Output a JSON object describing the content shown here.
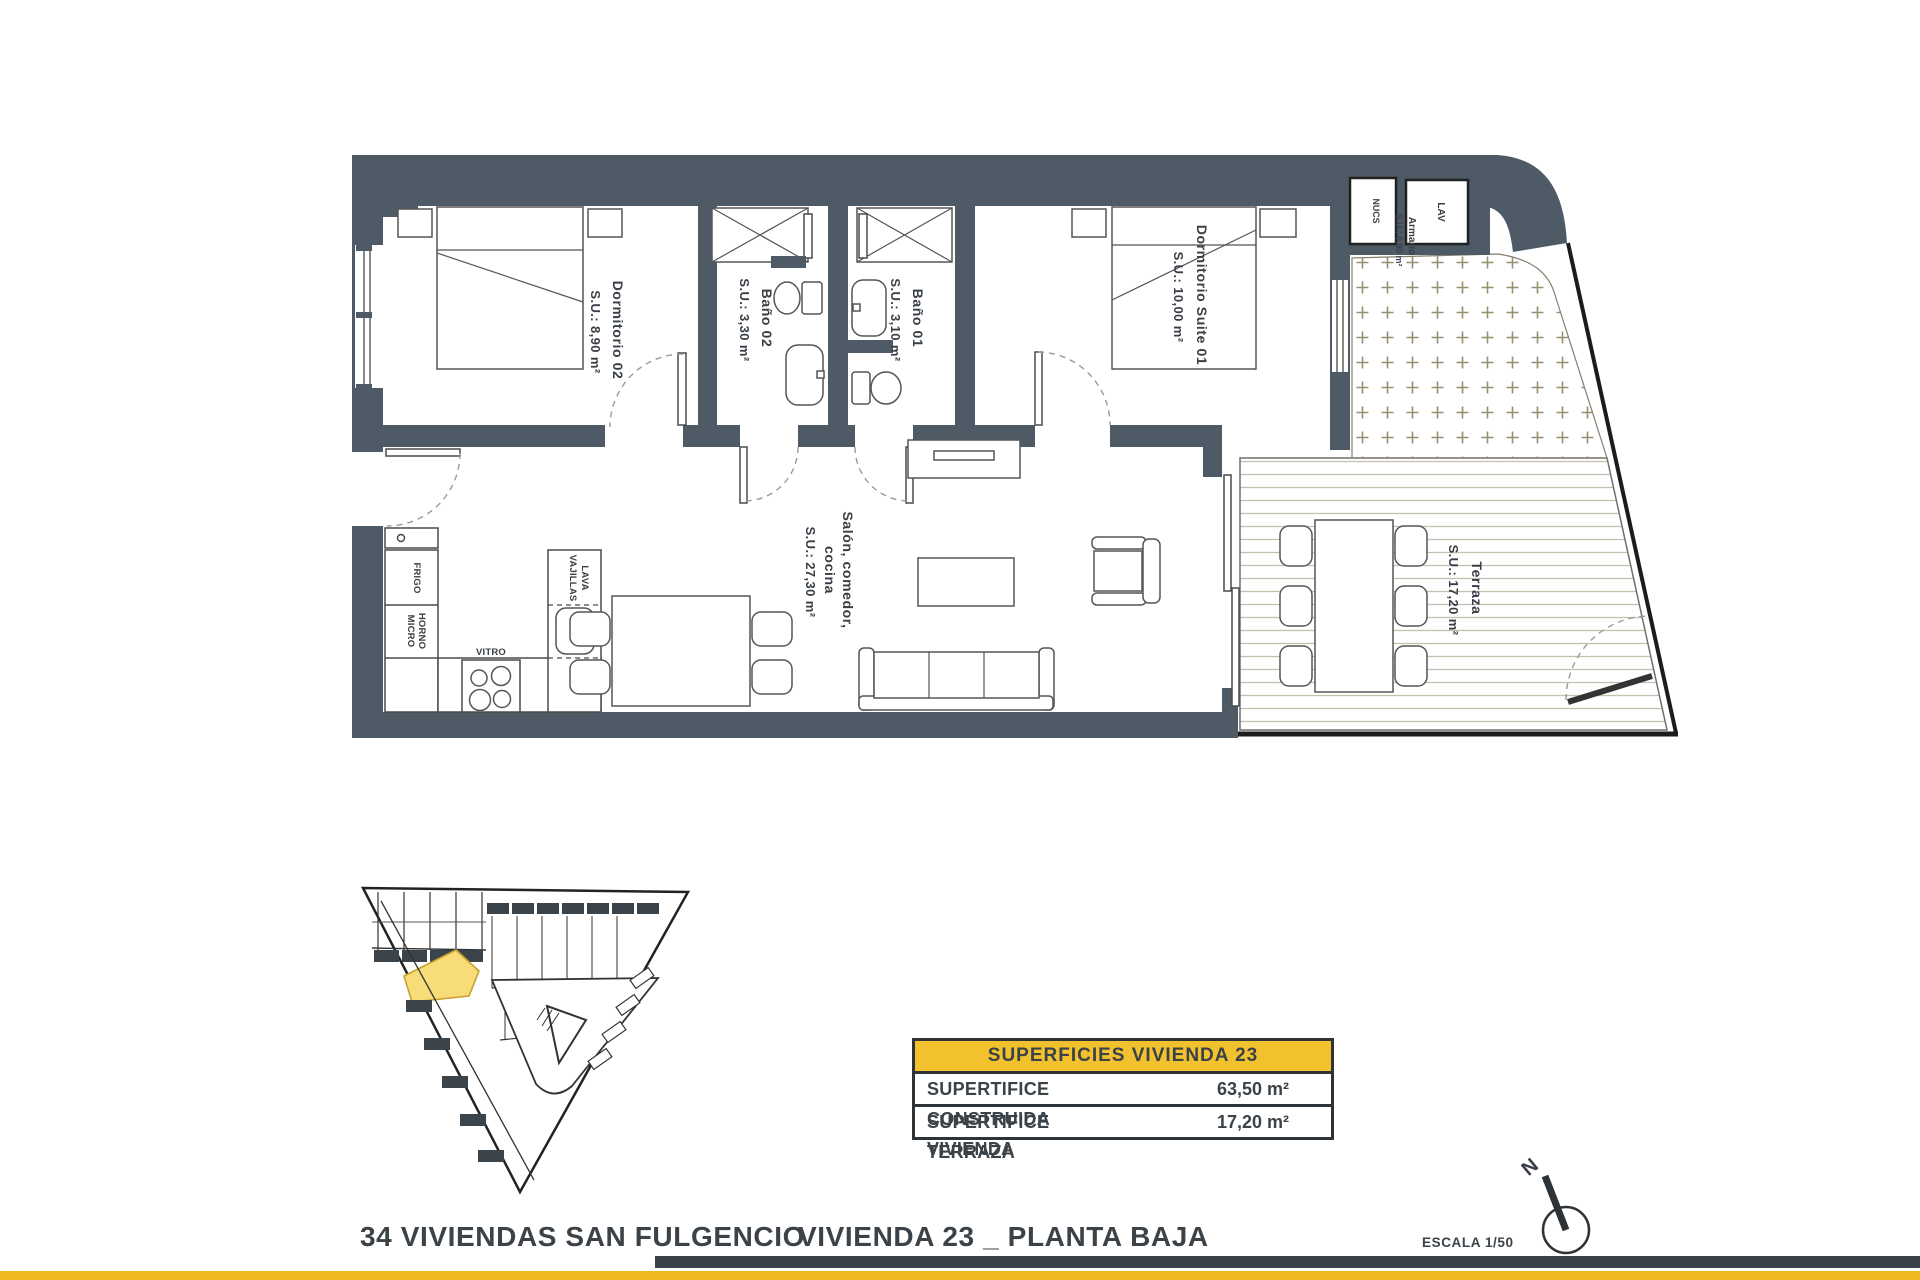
{
  "title_block": {
    "project": "34 VIVIENDAS SAN FULGENCIO",
    "sheet": "VIVIENDA 23 _ PLANTA BAJA",
    "scale": "ESCALA 1/50",
    "north_label": "N"
  },
  "surfaces_table": {
    "header": "SUPERFICIES VIVIENDA 23",
    "rows": [
      {
        "label": "SUPERTIFICE CONSTRUIDA VIVIENDA",
        "value": "63,50 m²"
      },
      {
        "label": "SUPERTIFICE TERRAZA",
        "value": "17,20 m²"
      }
    ]
  },
  "plan": {
    "rooms": {
      "dorm02": {
        "name": "Dormitorio 02",
        "area": "S.U.: 8,90 m²"
      },
      "bath02": {
        "name": "Baño 02",
        "area": "S.U.: 3,30 m²"
      },
      "bath01": {
        "name": "Baño 01",
        "area": "S.U.: 3,10 m²"
      },
      "suite01": {
        "name": "Dormitorio Suite 01",
        "area": "S.U.: 10,00 m²"
      },
      "salon": {
        "line1": "Salón, comedor,",
        "line2": "cocina",
        "area": "S.U.: 27,30 m²"
      },
      "terraza": {
        "name": "Terraza",
        "area": "S.U.: 17,20 m²"
      },
      "armario": {
        "name": "Armario",
        "area": "S.U.: 0,90 m²",
        "lav": "LAV",
        "nucs": "NUCS"
      }
    },
    "kitchen": {
      "frigo": "FRIGO",
      "horno": "HORNO",
      "micro": "MICRO",
      "vitro": "VITRO",
      "lava": "LAVA",
      "vajillas": "VAJILLAS"
    }
  },
  "colors": {
    "wall": "#4e5a65",
    "table_header_yellow": "#f2c12e",
    "footer_yellow": "#f2b822",
    "highlight_unit_yellow": "#f8dc78"
  }
}
